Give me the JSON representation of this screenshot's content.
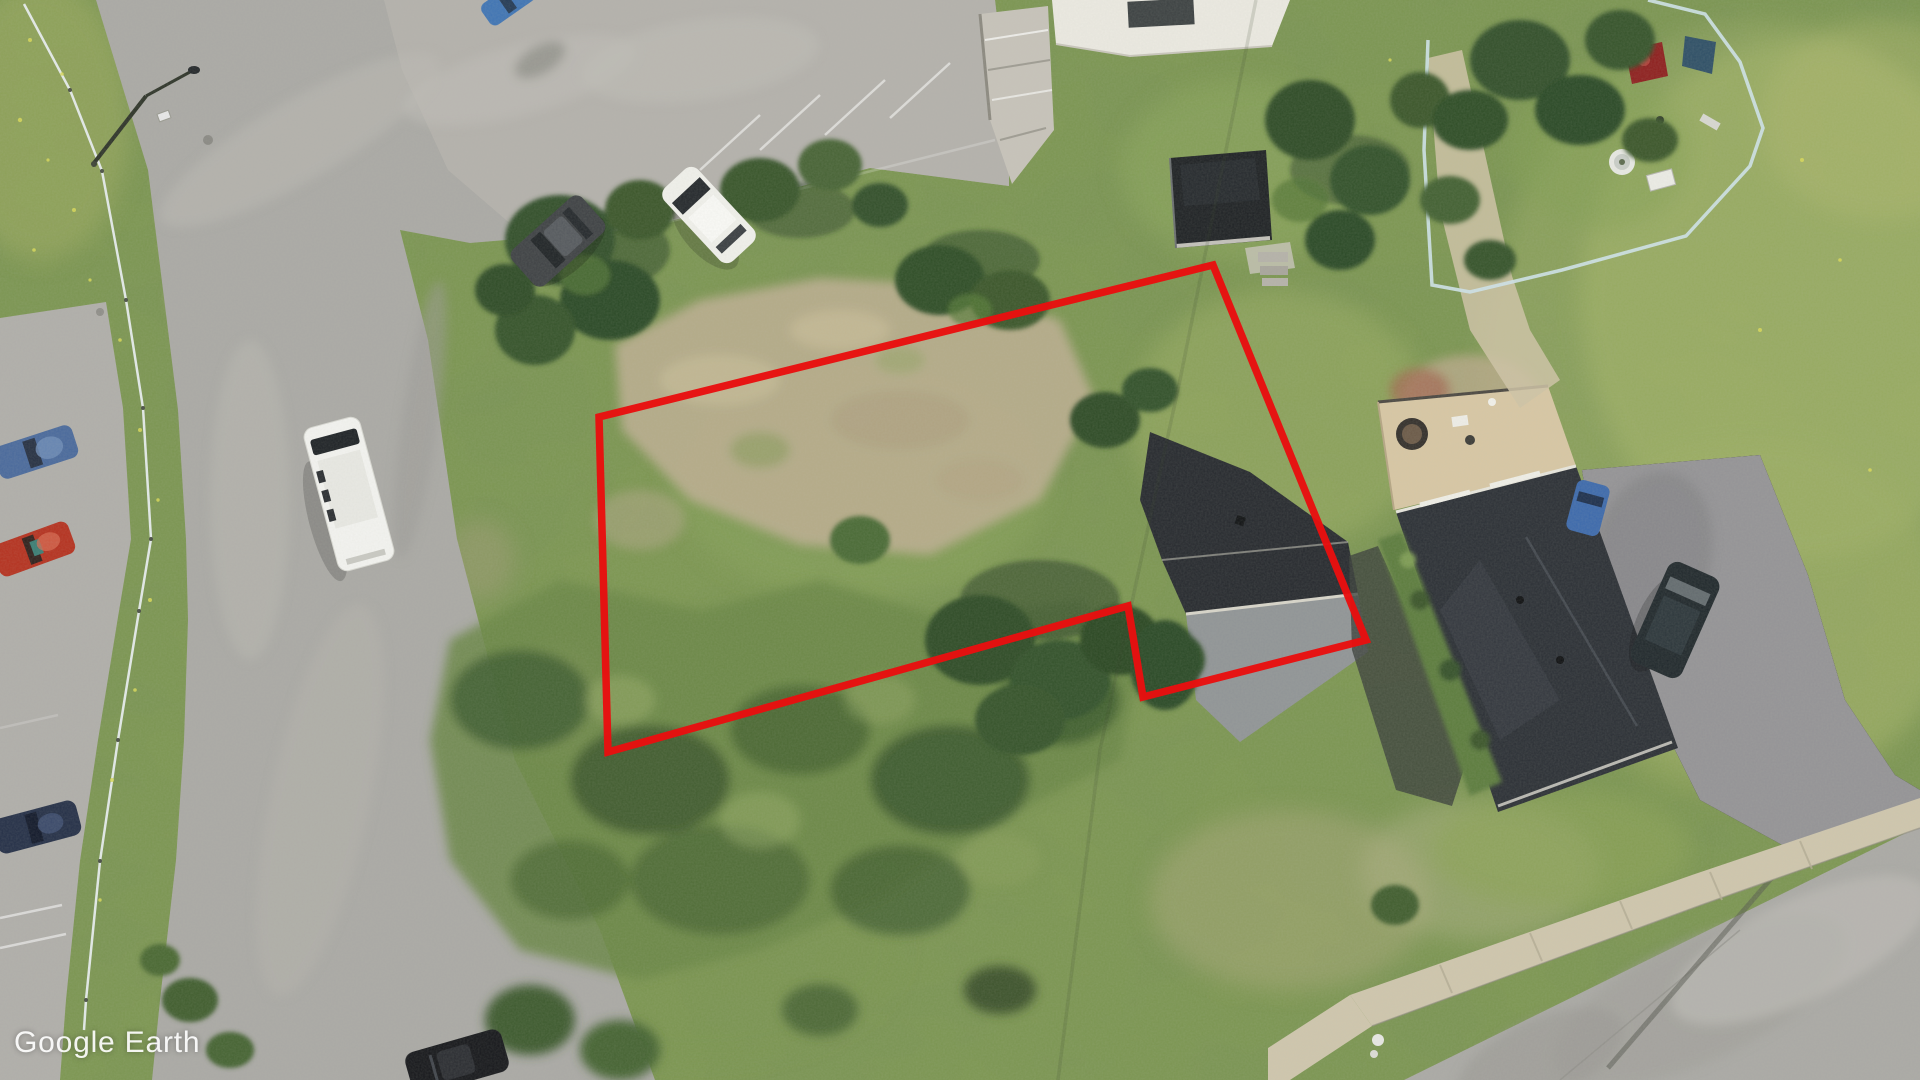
{
  "app": {
    "name": "Google Earth",
    "watermark": "Google Earth"
  },
  "view": {
    "type": "aerial-satellite-imagery",
    "width_px": 1920,
    "height_px": 1080
  },
  "annotation": {
    "name": "parcel-boundary-outline",
    "shape": "polygon",
    "color": "#e81010",
    "stroke_width": 7.5,
    "points": "599,417 1213,265 1366,640 1143,697 1128,606 608,752"
  },
  "colors": {
    "grass_base": "#7d9750",
    "road": "#aaa9a5",
    "road_dark": "#9a9995",
    "parking_lot": "#b6b3ad",
    "dirt": "#b7ac8b",
    "sidewalk": "#cfc6ad",
    "tree_dark": "#2f4d28",
    "shrub": "#6a8647",
    "roof_dark": "#26292e",
    "roof_dark2": "#2b2f35",
    "roof_light": "#909496",
    "deck_tan": "#d8c7a4",
    "fence_blue": "#cfe3ea",
    "guardrail": "#e9eef0",
    "watermark_text": "#ffffff"
  },
  "scene": {
    "description": "Oblique-free top-down aerial photo of a vacant grassy corner lot outlined in red, beside an intersection, a parking lot, two dark-roofed houses, a fenced yard and streets.",
    "features": [
      {
        "name": "parcel-boundary-outline",
        "kind": "annotation"
      },
      {
        "name": "intersection-road",
        "kind": "road"
      },
      {
        "name": "parking-lot",
        "kind": "pavement"
      },
      {
        "name": "bottom-right-street",
        "kind": "road"
      },
      {
        "name": "sidewalk",
        "kind": "path"
      },
      {
        "name": "guardrail",
        "kind": "barrier"
      },
      {
        "name": "street-light",
        "kind": "pole"
      },
      {
        "name": "vacant-lot-dirt-patch",
        "kind": "terrain"
      },
      {
        "name": "shrub-thicket",
        "kind": "vegetation"
      },
      {
        "name": "house-gable-roof",
        "kind": "building"
      },
      {
        "name": "house-large-dark-roof",
        "kind": "building"
      },
      {
        "name": "flat-roof-garage",
        "kind": "building"
      },
      {
        "name": "white-commercial-building",
        "kind": "building"
      },
      {
        "name": "deck-with-hot-tub",
        "kind": "structure"
      },
      {
        "name": "fenced-yard",
        "kind": "enclosure"
      },
      {
        "name": "white-van",
        "kind": "vehicle"
      },
      {
        "name": "white-car",
        "kind": "vehicle"
      },
      {
        "name": "dark-sedan-on-road",
        "kind": "vehicle"
      },
      {
        "name": "blue-parked-car",
        "kind": "vehicle"
      },
      {
        "name": "red-parked-car",
        "kind": "vehicle"
      },
      {
        "name": "navy-parked-car",
        "kind": "vehicle"
      },
      {
        "name": "black-car-bottom",
        "kind": "vehicle"
      },
      {
        "name": "dark-suv-driveway",
        "kind": "vehicle"
      },
      {
        "name": "small-blue-car-driveway",
        "kind": "vehicle"
      }
    ]
  }
}
